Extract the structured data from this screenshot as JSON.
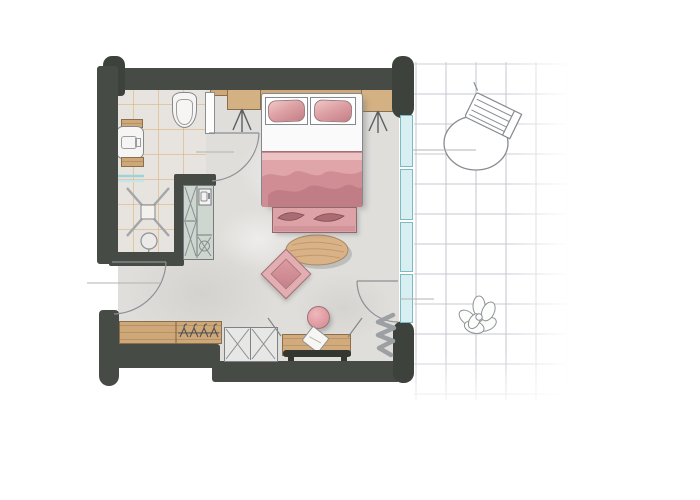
{
  "meta": {
    "scene": "Hand-drawn watercolor architectural floor plan of a hotel bedroom with en-suite bathroom and a tiled outdoor terrace",
    "visible_text": "none"
  },
  "palette": {
    "wall": "#474b45",
    "wall_cap": "#3e423c",
    "floor": "#dfdedb",
    "bathroom_floor": "#e7e4df",
    "bathroom_tile_line": "#dcae72",
    "wood": "#cfa87a",
    "pink_light": "#e5adb1",
    "pink_mid": "#d9969b",
    "pink_dark": "#aa6b73",
    "mint_cabinet": "#cdd6cf",
    "glass": "#d8eff1",
    "glass_frame": "#7abac2",
    "terrace_grid": "#c6c9d1",
    "linework": "#85888c"
  },
  "rooms": [
    {
      "name": "bathroom",
      "label": "Bathroom with tiled floor"
    },
    {
      "name": "bedroom",
      "label": "Bedroom"
    },
    {
      "name": "entry",
      "label": "Entry hall with wardrobe"
    },
    {
      "name": "terrace",
      "label": "Terrace with tile grid"
    }
  ],
  "furniture": {
    "bed": {
      "label": "Double bed with two pink pillows and pink blanket"
    },
    "pillow_left": {
      "label": "Left pillow"
    },
    "pillow_right": {
      "label": "Right pillow"
    },
    "nightstand_left": {
      "label": "Left nightstand with tripod legs"
    },
    "nightstand_right": {
      "label": "Right nightstand with tripod legs"
    },
    "headboard": {
      "label": "Wood headboard panel"
    },
    "foot_bench": {
      "label": "Pink bench at foot of bed with two cushions"
    },
    "rug": {
      "label": "Oval jute rug"
    },
    "floor_cushion": {
      "label": "Pink square floor cushion"
    },
    "stool": {
      "label": "Round pink stool"
    },
    "wardrobe": {
      "label": "Wardrobe with clothes rail and hangers"
    },
    "cabinet": {
      "label": "Low cabinet with crossed doors"
    },
    "luggage_bench": {
      "label": "Wood luggage bench with folded towel"
    },
    "console": {
      "label": "Dark wall-side bench"
    },
    "radiator": {
      "label": "Radiator / curtain squiggle symbol"
    },
    "toilet": {
      "label": "Toilet"
    },
    "washbasin": {
      "label": "Washbasin console with wood shelves"
    },
    "shower": {
      "label": "Walk-in shower with floor drain"
    },
    "floor_drain": {
      "label": "Round floor drain"
    },
    "vanity_unit": {
      "label": "Minibar / vanity unit with sink"
    },
    "terrace_table": {
      "label": "Round terrace table"
    },
    "terrace_chair": {
      "label": "Slatted terrace chair"
    },
    "plant": {
      "label": "Decorative flower"
    },
    "window_wall": {
      "label": "Glazed window wall with four panels"
    },
    "entrance_door": {
      "label": "Entrance door with swing arc"
    },
    "bathroom_door": {
      "label": "Bathroom door with swing arc"
    },
    "terrace_door": {
      "label": "Terrace door with swing arc"
    }
  }
}
